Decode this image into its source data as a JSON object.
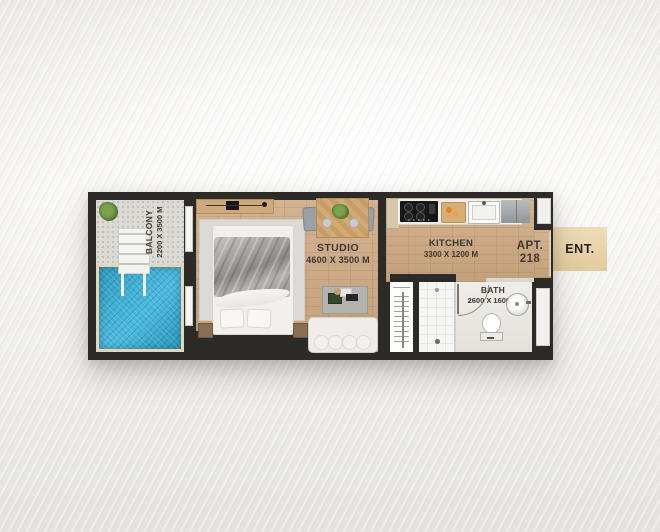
{
  "floorplan": {
    "apt": {
      "line1": "APT.",
      "line2": "218"
    },
    "entrance": {
      "label": "ENT."
    },
    "rooms": {
      "balcony": {
        "name": "BALCONY",
        "dims": "2200 X 3500 M"
      },
      "studio": {
        "name": "STUDIO",
        "dims": "4600 X 3500 M"
      },
      "kitchen": {
        "name": "KITCHEN",
        "dims": "3300 X 1200 M"
      },
      "bath": {
        "name": "BATH",
        "dims": "2600 X 1600 M"
      }
    },
    "colors": {
      "wall": "#2c2b28",
      "wood_floor": "#c9a47e",
      "balcony_tile": "#dbdad5",
      "pool_water": "#33a6cb",
      "pool_deck": "#e7d6b4",
      "entrance_badge": "#e9d5ab",
      "label_text": "#3e3831"
    },
    "furniture": [
      "plant",
      "pool",
      "pool-steps",
      "sliding-door",
      "bed",
      "pillows",
      "nightstands",
      "tv-console",
      "rug",
      "dining-table",
      "dining-chairs",
      "plant-centerpiece",
      "tall-cabinet",
      "stove",
      "cutting-board",
      "kitchen-sink",
      "fridge",
      "coffee-table",
      "sofa",
      "wardrobe",
      "shower",
      "toilet",
      "basin",
      "bath-door"
    ]
  }
}
